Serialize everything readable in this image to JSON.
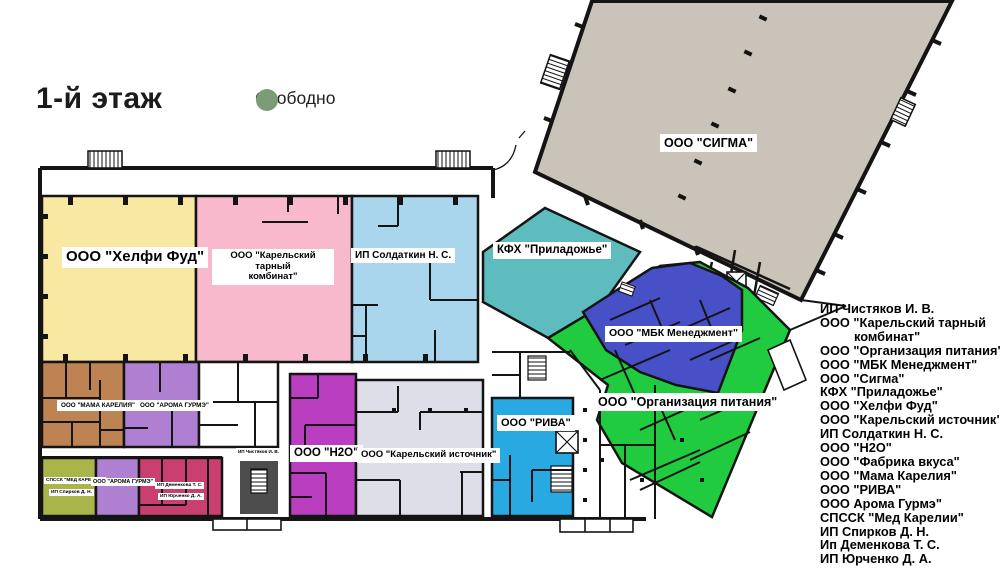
{
  "title": "1-й этаж",
  "legend": {
    "label": "Свободно",
    "dot_color": "#7E9B78"
  },
  "plan": {
    "wall_color": "#141414",
    "stair_shaft_color": "#4d4d4d",
    "regions": {
      "helfi": {
        "label": "ООО \"Хелфи Фуд\"",
        "color": "#F9E8A2"
      },
      "tarny": {
        "label_line1": "ООО \"Карельский тарный",
        "label_line2": "комбинат\"",
        "color": "#F8B9CC"
      },
      "soldatkin": {
        "label": "ИП Солдаткин Н. С.",
        "color": "#A9D6EC"
      },
      "priladozhye": {
        "label": "КФХ \"Приладожье\"",
        "color": "#5FBCBE"
      },
      "sigma": {
        "label": "ООО \"СИГМА\"",
        "color": "#C9C3B9"
      },
      "mbk": {
        "label": "ООО \"МБК Менеджмент\"",
        "color": "#4750C7"
      },
      "orgpit": {
        "label": "ООО \"Организация питания\"",
        "color": "#21CB40"
      },
      "mama": {
        "label": "ООО \"МАМА КАРЕЛИЯ\"",
        "color": "#BE8352"
      },
      "aroma": {
        "label": "ООО \"АРОМА ГУРМЭ\"",
        "color": "#AF80D2"
      },
      "h2o": {
        "label": "ООО \"Н2О\"",
        "color": "#BA3FC0"
      },
      "istochnik": {
        "label": "ООО \"Карельский источник\"",
        "color": "#DEDEE9"
      },
      "riva": {
        "label": "ООО \"РИВА\"",
        "color": "#29A9E1"
      },
      "med": {
        "label": "СПССК \"МЕД КАРЕЛИИ\"",
        "color": "#A9B449"
      },
      "spirkov": {
        "label": "ИП Спирков  Д. Н."
      },
      "demenkova": {
        "label": "ИП Деменкова Т. С.",
        "color": "#C94070"
      },
      "yurchenko": {
        "label": "ИП Юрченко Д. А."
      },
      "chistyakov": {
        "label": "ИП Чистяков И. В."
      }
    }
  },
  "tenant_list": {
    "items": [
      "ИП Чистяков И. В.",
      "ООО \"Карельский тарный",
      "комбинат\"",
      "ООО \"Организация питания\"",
      "ООО \"МБК Менеджмент\"",
      "ООО \"Сигма\"",
      "КФХ \"Приладожье\"",
      "ООО \"Хелфи Фуд\"",
      "ООО \"Карельский источник\"",
      "ИП Солдаткин Н. С.",
      "ООО \"Н2О\"",
      "ООО \"Фабрика вкуса\"",
      "ООО \"Мама Карелия\"",
      "ООО \"РИВА\"",
      "ООО Арома Гурмэ\"",
      "СПССК \"Мед Карелии\"",
      "ИП Спирков Д. Н.",
      "Ип Деменкова  Т. С.",
      "ИП Юрченко Д. А."
    ]
  }
}
